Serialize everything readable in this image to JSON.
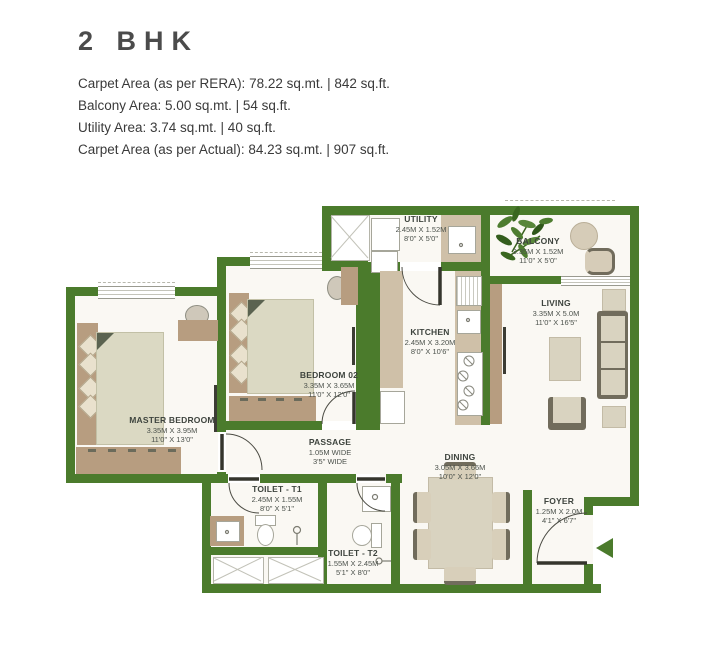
{
  "header": {
    "title": "2 BHK",
    "area_lines": [
      "Carpet Area (as per RERA): 78.22 sq.mt. | 842 sq.ft.",
      "Balcony Area: 5.00 sq.mt. | 54 sq.ft.",
      "Utility Area: 3.74 sq.mt. | 40 sq.ft.",
      "Carpet Area (as per Actual): 84.23 sq.mt. | 907 sq.ft."
    ]
  },
  "rooms": {
    "utility": {
      "name": "UTILITY",
      "dim_m": "2.45M X 1.52M",
      "dim_ft": "8'0\" X 5'0\""
    },
    "balcony": {
      "name": "BALCONY",
      "dim_m": "3.35M X 1.52M",
      "dim_ft": "11'0\" X 5'0\""
    },
    "living": {
      "name": "LIVING",
      "dim_m": "3.35M X 5.0M",
      "dim_ft": "11'0\" X 16'5\""
    },
    "kitchen": {
      "name": "KITCHEN",
      "dim_m": "2.45M X 3.20M",
      "dim_ft": "8'0\" X 10'6\""
    },
    "bedroom02": {
      "name": "BEDROOM 02",
      "dim_m": "3.35M X 3.65M",
      "dim_ft": "11'0\" X 12'0\""
    },
    "master_bedroom": {
      "name": "MASTER BEDROOM",
      "dim_m": "3.35M X 3.95M",
      "dim_ft": "11'0\" X 13'0\""
    },
    "passage": {
      "name": "PASSAGE",
      "dim_m": "1.05M WIDE",
      "dim_ft": "3'5\" WIDE"
    },
    "toilet_t1": {
      "name": "TOILET - T1",
      "dim_m": "2.45M X 1.55M",
      "dim_ft": "8'0\" X 5'1\""
    },
    "toilet_t2": {
      "name": "TOILET - T2",
      "dim_m": "1.55M X 2.45M",
      "dim_ft": "5'1\" X 8'0\""
    },
    "dining": {
      "name": "DINING",
      "dim_m": "3.05M X 3.66M",
      "dim_ft": "10'0\" X 12'0\""
    },
    "foyer": {
      "name": "FOYER",
      "dim_m": "1.25M X 2.0M",
      "dim_ft": "4'1\" X 6'7\""
    }
  },
  "colors": {
    "wall": "#4b7b2c",
    "floor": "#faf8f3",
    "wood": "#b79d80",
    "counter": "#cfc0a8",
    "fabric": "#d9d3c0",
    "frame": "#716c5c",
    "text": "#3e443e"
  }
}
